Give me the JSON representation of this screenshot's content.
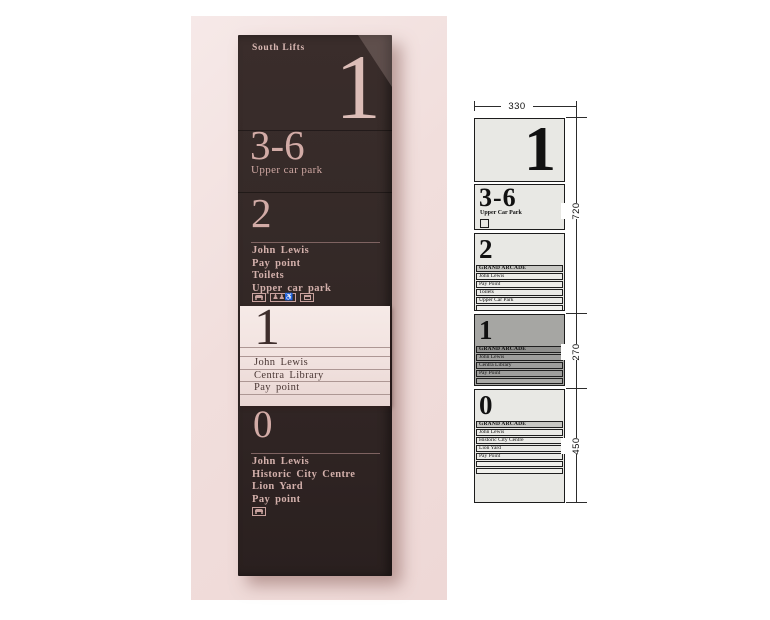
{
  "photo": {
    "title": "South Lifts",
    "top_level_number": "1",
    "range_level": {
      "number": "3-6",
      "label": "Upper car park"
    },
    "level2": {
      "number": "2",
      "items": [
        "John Lewis",
        "Pay point",
        "Toilets",
        "Upper car park"
      ]
    },
    "band": {
      "number": "1",
      "items": [
        "John Lewis",
        "Centra Library",
        "Pay point"
      ]
    },
    "level0": {
      "number": "0",
      "items": [
        "John Lewis",
        "Historic City Centre",
        "Lion Yard",
        "Pay point"
      ]
    },
    "icons": {
      "row": [
        "car-icon",
        "lift-accessible-icon",
        "bus-icon"
      ],
      "bottom": [
        "car-icon"
      ]
    }
  },
  "schematic": {
    "dims": {
      "width": "330",
      "upper": "720",
      "middle": "270",
      "lower": "450"
    },
    "s1": {
      "number": "1"
    },
    "s2": {
      "number": "3-6",
      "label": "Upper Car Park"
    },
    "s3": {
      "number": "2",
      "slats": [
        "GRAND ARCADE",
        "John Lewis",
        "Pay Point",
        "Toilets",
        "Upper Car Park"
      ]
    },
    "s4": {
      "number": "1",
      "slats": [
        "GRAND ARCADE",
        "John Lewis",
        "Centra Library",
        "Pay Point"
      ]
    },
    "s5": {
      "number": "0",
      "slats": [
        "GRAND ARCADE",
        "John Lewis",
        "Historic City Centre",
        "Lion Yard",
        "Pay Point"
      ]
    }
  },
  "colors": {
    "photo_background": "#f1dedc",
    "sign_panel": "#332827",
    "sign_text_pink": "#d3b0ab",
    "slide_band": "#f1e2df",
    "schematic_panel": "#e8e8e4",
    "schematic_highlight": "#a6a6a3",
    "line": "#1c1c1c"
  }
}
